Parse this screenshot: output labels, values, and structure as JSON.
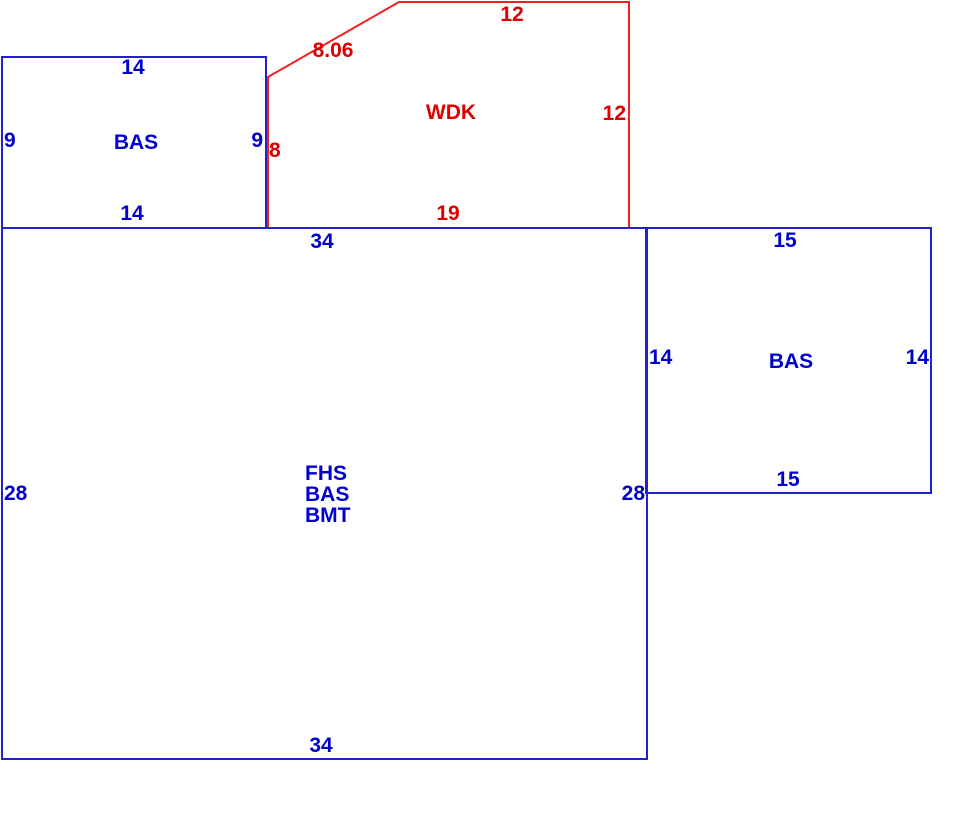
{
  "colors": {
    "blue_text": "#0000cc",
    "red_text": "#dd0000",
    "blue_line": "#2222cc",
    "red_line": "#ee2222",
    "background": "#ffffff"
  },
  "sketch": {
    "areas": [
      {
        "code": "BAS",
        "position": "upper-left",
        "outline_color": "blue",
        "dims": {
          "top": "14",
          "left": "9",
          "right": "9",
          "bottom": "14"
        }
      },
      {
        "code": "WDK",
        "position": "upper-middle",
        "outline_color": "red",
        "dims": {
          "diagonal": "8.06",
          "top": "12",
          "right": "12",
          "left": "8",
          "bottom": "19"
        }
      },
      {
        "code_lines": [
          "FHS",
          "BAS",
          "BMT"
        ],
        "position": "main",
        "outline_color": "blue",
        "dims": {
          "top": "34",
          "left": "28",
          "right": "28",
          "bottom": "34"
        }
      },
      {
        "code": "BAS",
        "position": "right",
        "outline_color": "blue",
        "dims": {
          "top": "15",
          "left": "14",
          "right": "14",
          "bottom": "15"
        }
      }
    ]
  }
}
